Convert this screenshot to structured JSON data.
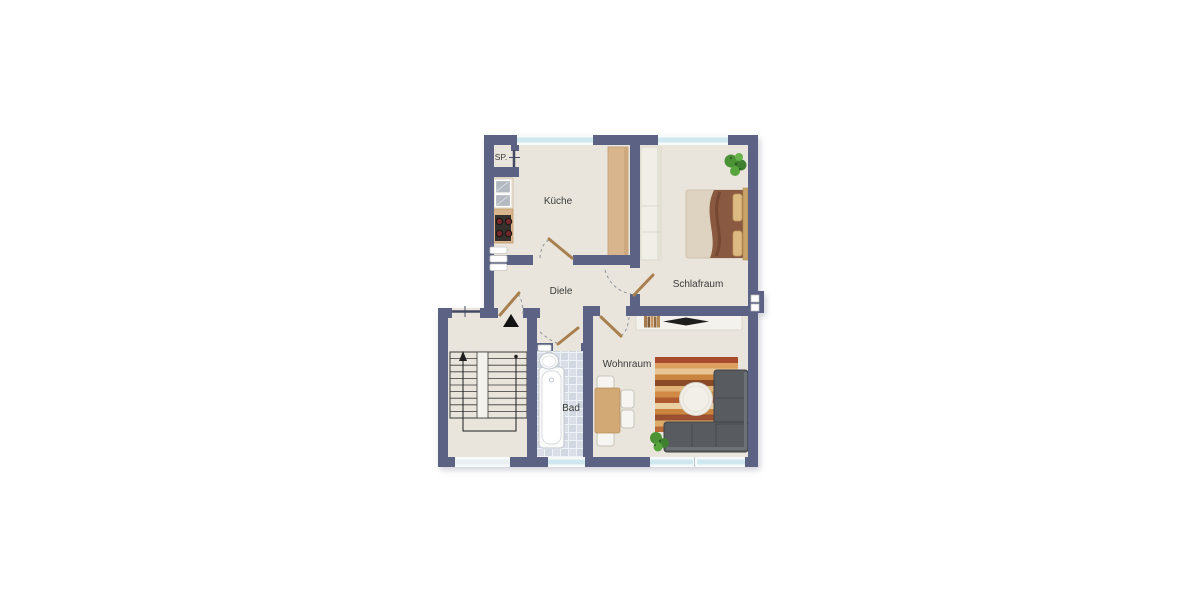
{
  "floor_plan": {
    "rooms": [
      {
        "id": "pantry",
        "label": "SP."
      },
      {
        "id": "kitchen",
        "label": "Küche"
      },
      {
        "id": "bedroom",
        "label": "Schlafraum"
      },
      {
        "id": "hallway",
        "label": "Diele"
      },
      {
        "id": "bathroom",
        "label": "Bad"
      },
      {
        "id": "livingroom",
        "label": "Wohnraum"
      }
    ],
    "colors": {
      "wall": "#5b6284",
      "floor": "#e9e5dc",
      "window_glass": "#cfe7ef",
      "bath_tile": "#d9dee6",
      "door_leaf": "#a8804f",
      "kitchen_cabinet": "#d9b58e",
      "sofa": "#585c61",
      "rug_main": "#c9853f",
      "plant": "#4c9336",
      "bed_blanket": "#8a5941"
    },
    "icons": {
      "entrance_marker": "up-triangle"
    }
  }
}
